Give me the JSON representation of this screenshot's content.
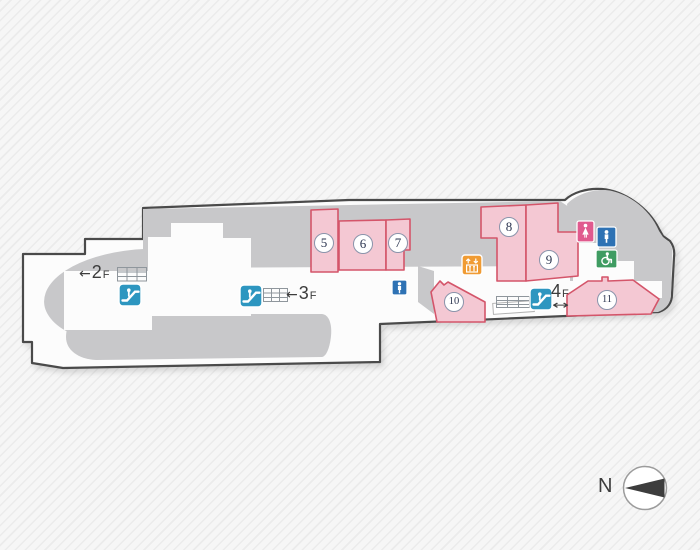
{
  "map": {
    "type": "station-floor-plan",
    "rooms": [
      {
        "label": "5",
        "x": 324,
        "y": 243
      },
      {
        "label": "6",
        "x": 363,
        "y": 244
      },
      {
        "label": "7",
        "x": 398,
        "y": 243
      },
      {
        "label": "8",
        "x": 509,
        "y": 227
      },
      {
        "label": "9",
        "x": 549,
        "y": 260
      },
      {
        "label": "10",
        "x": 454,
        "y": 302
      },
      {
        "label": "11",
        "x": 607,
        "y": 300
      }
    ],
    "floor_links": [
      {
        "id": "2F",
        "arrow": "←",
        "num": "2",
        "suffix": "F"
      },
      {
        "id": "3F",
        "arrow": "←",
        "num": "3",
        "suffix": "F"
      },
      {
        "id": "4F",
        "arrow": "↔",
        "num": "4",
        "suffix": "F"
      }
    ],
    "compass": {
      "label": "N"
    },
    "icons": [
      {
        "name": "escalator-to-2f-icon"
      },
      {
        "name": "escalator-to-3f-icon"
      },
      {
        "name": "escalator-to-4f-icon"
      },
      {
        "name": "elevator-icon"
      },
      {
        "name": "mens-toilet-icon"
      },
      {
        "name": "womens-toilet-icon"
      },
      {
        "name": "mens-toilet-dome-icon"
      },
      {
        "name": "accessible-toilet-icon"
      },
      {
        "name": "compass-north-icon"
      }
    ]
  },
  "colors": {
    "zone": "#c8c8ca",
    "floor": "#fcfcfc",
    "outline_col": "#4a4a4a",
    "room_fill": "#f4c8d3",
    "room_border": "#d4556a",
    "esc_blue": "#2d96c0",
    "elev_orange": "#f09b33",
    "mens_blue": "#2e72b4",
    "womens_pink": "#e05a8e",
    "access_green": "#3f9c62",
    "ink": "#3c3c3c",
    "badge_border": "#8a94ab",
    "badge_text": "#2c3550",
    "ladder": "#8f969c",
    "compass_dark": "#3d3d3d",
    "compass_ring": "#9c9c9c"
  }
}
